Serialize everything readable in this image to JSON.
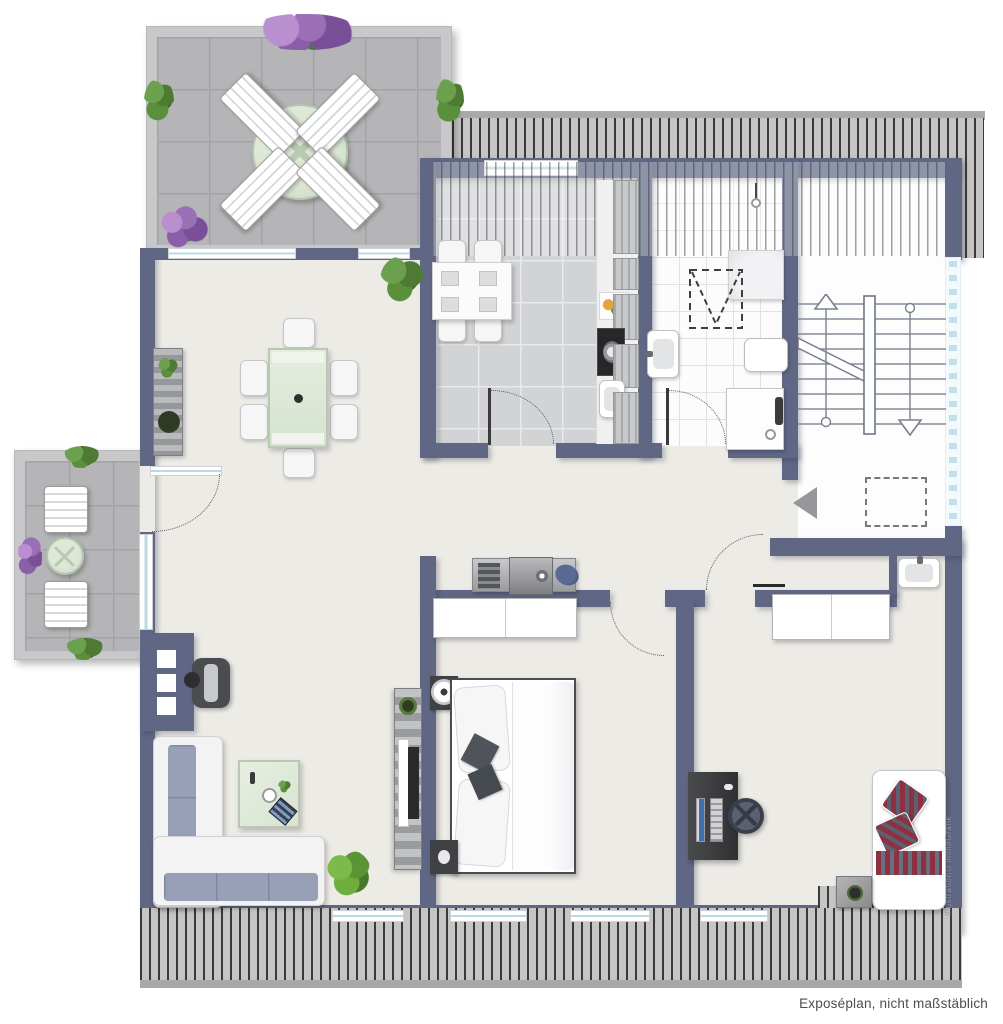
{
  "footer": {
    "text": "Exposéplan, nicht maßstäblich"
  },
  "watermark": {
    "text": "Illustration©immoGrafik"
  },
  "colors": {
    "wall": "#5f6785",
    "floor": "#edebe6",
    "tile_kitchen": "#d2d3d5",
    "tile_terrace": "#b5b5b7",
    "terrace_border": "#c8c8ca",
    "bath_floor": "#fcfcfd",
    "glass": "#bcd9e2",
    "hatch_bg": "#c6c5c3",
    "hatch_line": "#3a3a3c",
    "table_green": "#dfe8da",
    "cushion_blue": "#97a0b6",
    "pillow_red": "#8e3040",
    "plant_green": "#5a8f3c",
    "flower_purple": "#9b6fb5",
    "text_gray": "#4d4d4d",
    "watermark_color": "#8b93a8"
  },
  "rooms": {
    "terrace": [
      "roof-terrace",
      "round-table",
      "sun-loungers",
      "planters"
    ],
    "balcony": [
      "balcony",
      "round-table",
      "sun-loungers",
      "planters"
    ],
    "living_dining": [
      "dining-table",
      "chairs",
      "corner-sofa",
      "coffee-table",
      "armchair",
      "chimney",
      "tv-sideboard",
      "plants"
    ],
    "kitchen": [
      "kitchen-table",
      "chairs",
      "kitchen-counter",
      "stove",
      "sink",
      "fruit-bowl"
    ],
    "bathroom": [
      "shower",
      "second-shower",
      "wash-basin",
      "roof-window-marking",
      "shower-fixture"
    ],
    "stairwell": [
      "staircase",
      "up-arrow",
      "down-arrow",
      "entrance-arrow",
      "roof-window-marking",
      "glass-wall"
    ],
    "hallway": [
      "sideboard",
      "wash-basin"
    ],
    "bedroom": [
      "double-bed",
      "nightstands",
      "bed-lamp",
      "wardrobe",
      "pillows"
    ],
    "office": [
      "desk",
      "monitor",
      "office-chair",
      "wardrobe",
      "daybed",
      "side-table"
    ]
  }
}
